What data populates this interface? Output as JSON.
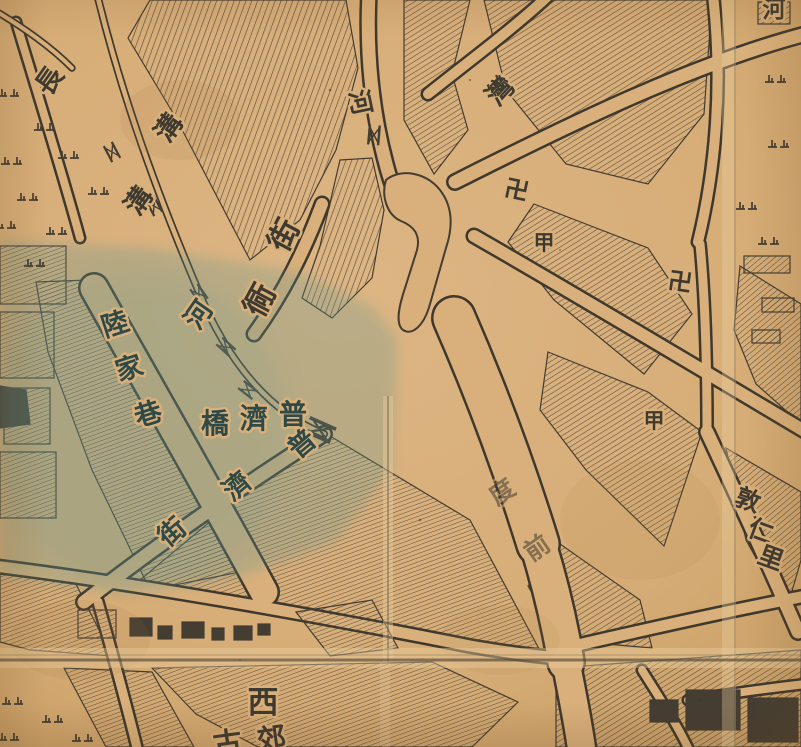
{
  "map": {
    "kind": "historical-woodblock-city-map",
    "description_visible_features": "hand-hatched city blocks, canals with bridges, wide river street, temple swastika marks, marsh tufts, paper fold creases, blue-green wash over south-west quarter",
    "colors": {
      "paper": "#d9b07b",
      "paper_light": "#ecd0a0",
      "paper_dark": "#c2955c",
      "ink": "#443d32",
      "ink_road": "#3f382d",
      "hatch": "#4b443a",
      "wash": "#5f958f",
      "crease_light": "#ecd0a0",
      "crease_dark": "#4a3e2f",
      "label_ink": "#3f3a30",
      "label_teal": "#2e4a48"
    },
    "reading_groups": [
      {
        "name": "長溝",
        "meaning_role": "canal name, top-left"
      },
      {
        "name": "河",
        "meaning_role": "river labels along waterways"
      },
      {
        "name": "街 / 衕",
        "meaning_role": "street corridor labels, centre"
      },
      {
        "name": "灣",
        "meaning_role": "river bend label, top-right"
      },
      {
        "name": "陸家巷",
        "meaning_role": "lane name, west (in blue wash)"
      },
      {
        "name": "普濟橋",
        "meaning_role": "bridge name, centre-west"
      },
      {
        "name": "普濟街",
        "meaning_role": "street name, diagonal south-west"
      },
      {
        "name": "度前",
        "meaning_role": "faint street label on wide street"
      },
      {
        "name": "敦仁里",
        "meaning_role": "alley name, east edge"
      },
      {
        "name": "西",
        "meaning_role": "district character, bottom centre"
      },
      {
        "name": "卍",
        "meaning_role": "temple marks"
      },
      {
        "name": "甲",
        "meaning_role": "block numbering marks"
      }
    ],
    "place_labels": [
      {
        "text": "長",
        "x": 57,
        "y": 86,
        "rotate": -55,
        "size": 27,
        "color": "ink",
        "kind": "water-name"
      },
      {
        "text": "溝",
        "x": 176,
        "y": 133,
        "rotate": -55,
        "size": 27,
        "color": "ink",
        "kind": "water-name"
      },
      {
        "text": "溝",
        "x": 146,
        "y": 206,
        "rotate": -55,
        "size": 27,
        "color": "ink",
        "kind": "water-name"
      },
      {
        "text": "河",
        "x": 352,
        "y": 104,
        "rotate": 78,
        "size": 25,
        "color": "ink",
        "kind": "water-name"
      },
      {
        "text": "街",
        "x": 293,
        "y": 240,
        "rotate": -62,
        "size": 31,
        "color": "ink",
        "kind": "street-name"
      },
      {
        "text": "衕",
        "x": 269,
        "y": 305,
        "rotate": -62,
        "size": 31,
        "color": "ink",
        "kind": "street-name"
      },
      {
        "text": "河",
        "x": 206,
        "y": 320,
        "rotate": -55,
        "size": 27,
        "color": "teal",
        "kind": "water-name"
      },
      {
        "text": "灣",
        "x": 507,
        "y": 97,
        "rotate": -48,
        "size": 27,
        "color": "ink",
        "kind": "water-name"
      },
      {
        "text": "卍",
        "x": 515,
        "y": 198,
        "rotate": 12,
        "size": 24,
        "color": "ink",
        "kind": "temple-symbol"
      },
      {
        "text": "甲",
        "x": 544,
        "y": 250,
        "rotate": 0,
        "size": 21,
        "color": "ink",
        "kind": "block-marker"
      },
      {
        "text": "卍",
        "x": 679,
        "y": 290,
        "rotate": 8,
        "size": 24,
        "color": "ink",
        "kind": "temple-symbol"
      },
      {
        "text": "甲",
        "x": 654,
        "y": 428,
        "rotate": 0,
        "size": 21,
        "color": "ink",
        "kind": "block-marker"
      },
      {
        "text": "陸",
        "x": 118,
        "y": 333,
        "rotate": -18,
        "size": 27,
        "color": "teal",
        "kind": "street-name"
      },
      {
        "text": "家",
        "x": 132,
        "y": 377,
        "rotate": -18,
        "size": 27,
        "color": "teal",
        "kind": "street-name"
      },
      {
        "text": "巷",
        "x": 151,
        "y": 423,
        "rotate": -18,
        "size": 27,
        "color": "teal",
        "kind": "street-name"
      },
      {
        "text": "橋",
        "x": 215,
        "y": 433,
        "rotate": 0,
        "size": 28,
        "color": "teal",
        "kind": "bridge-name"
      },
      {
        "text": "濟",
        "x": 254,
        "y": 428,
        "rotate": 0,
        "size": 28,
        "color": "teal",
        "kind": "bridge-name"
      },
      {
        "text": "普",
        "x": 293,
        "y": 424,
        "rotate": 0,
        "size": 28,
        "color": "teal",
        "kind": "bridge-name"
      },
      {
        "text": "普",
        "x": 308,
        "y": 451,
        "rotate": -40,
        "size": 27,
        "color": "teal",
        "kind": "street-name"
      },
      {
        "text": "濟",
        "x": 243,
        "y": 493,
        "rotate": -40,
        "size": 27,
        "color": "teal",
        "kind": "street-name"
      },
      {
        "text": "街",
        "x": 178,
        "y": 539,
        "rotate": -40,
        "size": 27,
        "color": "teal",
        "kind": "street-name"
      },
      {
        "text": "度",
        "x": 507,
        "y": 499,
        "rotate": -35,
        "size": 25,
        "color": "ink",
        "opacity": 0.55,
        "kind": "street-name-faint"
      },
      {
        "text": "前",
        "x": 542,
        "y": 555,
        "rotate": -35,
        "size": 25,
        "color": "ink",
        "opacity": 0.55,
        "kind": "street-name-faint"
      },
      {
        "text": "敦",
        "x": 745,
        "y": 508,
        "rotate": 20,
        "size": 25,
        "color": "ink",
        "kind": "alley-name"
      },
      {
        "text": "仁",
        "x": 758,
        "y": 539,
        "rotate": 20,
        "size": 25,
        "color": "ink",
        "kind": "alley-name"
      },
      {
        "text": "里",
        "x": 768,
        "y": 566,
        "rotate": 20,
        "size": 25,
        "color": "ink",
        "kind": "alley-name"
      },
      {
        "text": "西",
        "x": 263,
        "y": 713,
        "rotate": 0,
        "size": 31,
        "color": "ink",
        "kind": "district-name"
      },
      {
        "text": "古",
        "x": 229,
        "y": 753,
        "rotate": -8,
        "size": 29,
        "color": "ink",
        "kind": "district-name-partial"
      },
      {
        "text": "郊",
        "x": 273,
        "y": 749,
        "rotate": -8,
        "size": 29,
        "color": "ink",
        "kind": "district-name-partial"
      },
      {
        "text": "河",
        "x": 774,
        "y": 17,
        "rotate": 0,
        "size": 23,
        "color": "ink",
        "kind": "water-name-partial"
      }
    ],
    "symbols": {
      "bridges": [
        {
          "x": 112,
          "y": 152,
          "rotate": 62,
          "scale": 1
        },
        {
          "x": 154,
          "y": 206,
          "rotate": 62,
          "scale": 1
        },
        {
          "x": 199,
          "y": 294,
          "rotate": 55,
          "scale": 1
        },
        {
          "x": 226,
          "y": 347,
          "rotate": 42,
          "scale": 1
        },
        {
          "x": 248,
          "y": 390,
          "rotate": 38,
          "scale": 1
        },
        {
          "x": 320,
          "y": 430,
          "rotate": 24,
          "scale": 1.6
        },
        {
          "x": 374,
          "y": 135,
          "rotate": -85,
          "scale": 1.1
        }
      ],
      "marsh_tufts": [
        {
          "x": 10,
          "y": 92
        },
        {
          "x": 46,
          "y": 126
        },
        {
          "x": 13,
          "y": 160
        },
        {
          "x": 70,
          "y": 154
        },
        {
          "x": 29,
          "y": 196
        },
        {
          "x": 100,
          "y": 190
        },
        {
          "x": 7,
          "y": 224
        },
        {
          "x": 58,
          "y": 230
        },
        {
          "x": 36,
          "y": 262
        },
        {
          "x": 777,
          "y": 78
        },
        {
          "x": 780,
          "y": 143
        },
        {
          "x": 748,
          "y": 205
        },
        {
          "x": 770,
          "y": 240
        },
        {
          "x": 14,
          "y": 700
        },
        {
          "x": 54,
          "y": 718
        },
        {
          "x": 10,
          "y": 736
        },
        {
          "x": 84,
          "y": 737
        }
      ]
    }
  }
}
